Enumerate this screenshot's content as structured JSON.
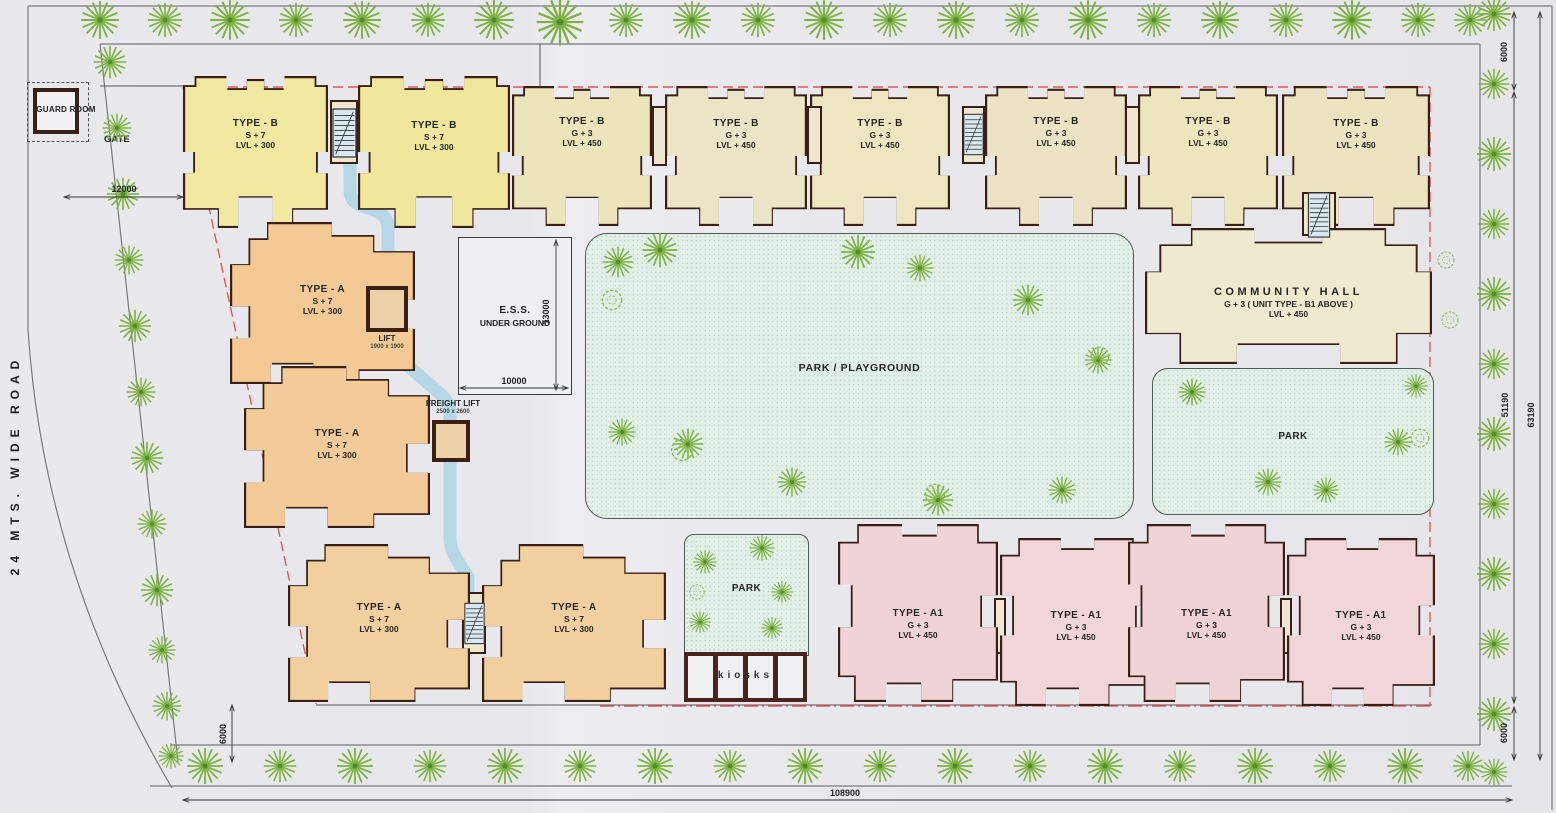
{
  "plan": {
    "road_label": "24 MTS. WIDE ROAD",
    "gate_label": "GATE",
    "guard_room_label": "GUARD ROOM"
  },
  "type_b_blocks": [
    {
      "name": "TYPE - B",
      "floors": "S + 7",
      "level": "LVL + 300"
    },
    {
      "name": "TYPE - B",
      "floors": "S + 7",
      "level": "LVL + 300"
    },
    {
      "name": "TYPE - B",
      "floors": "G + 3",
      "level": "LVL + 450"
    },
    {
      "name": "TYPE - B",
      "floors": "G + 3",
      "level": "LVL + 450"
    },
    {
      "name": "TYPE - B",
      "floors": "G + 3",
      "level": "LVL + 450"
    },
    {
      "name": "TYPE - B",
      "floors": "G + 3",
      "level": "LVL + 450"
    },
    {
      "name": "TYPE - B",
      "floors": "G + 3",
      "level": "LVL + 450"
    },
    {
      "name": "TYPE - B",
      "floors": "G + 3",
      "level": "LVL + 450"
    }
  ],
  "type_a_blocks": [
    {
      "name": "TYPE - A",
      "floors": "S + 7",
      "level": "LVL + 300"
    },
    {
      "name": "TYPE - A",
      "floors": "S + 7",
      "level": "LVL + 300"
    },
    {
      "name": "TYPE - A",
      "floors": "S + 7",
      "level": "LVL + 300"
    },
    {
      "name": "TYPE - A",
      "floors": "S + 7",
      "level": "LVL + 300"
    }
  ],
  "type_a1_blocks": [
    {
      "name": "TYPE - A1",
      "floors": "G + 3",
      "level": "LVL + 450"
    },
    {
      "name": "TYPE - A1",
      "floors": "G + 3",
      "level": "LVL + 450"
    },
    {
      "name": "TYPE - A1",
      "floors": "G + 3",
      "level": "LVL + 450"
    },
    {
      "name": "TYPE - A1",
      "floors": "G + 3",
      "level": "LVL + 450"
    }
  ],
  "community_hall": {
    "name": "COMMUNITY HALL",
    "floors": "G + 3 ( UNIT TYPE - B1 ABOVE )",
    "level": "LVL + 450"
  },
  "ess": {
    "line1": "E.S.S.",
    "line2": "UNDER GROUND"
  },
  "parks": {
    "playground": "PARK / PLAYGROUND",
    "east": "PARK",
    "south": "PARK"
  },
  "kiosks_label": "kiosks",
  "lift": {
    "label": "LIFT",
    "size": "1900 x 1900"
  },
  "freight_lift": {
    "label": "FREIGHT LIFT",
    "size": "2500 x 2600"
  },
  "dimensions": {
    "top_left": "12000",
    "ess_height": "13000",
    "ess_width": "10000",
    "top_right": "6000",
    "right_inner": "51190",
    "right_outer": "63190",
    "bottom_right": "6000",
    "bottom_left": "6000",
    "bottom": "108900"
  },
  "colors": {
    "wall": "#3a1f16",
    "boundary_red": "#e05858",
    "walkway_blue": "#b3d7e6",
    "type_b_yellow": "#f1e9a2",
    "type_b_cream": "#ece4c6",
    "type_a_orange": "#f3c995",
    "type_a1_pink": "#efd3d6",
    "park_green": "#e2efe8",
    "tree_green": "#7cb342"
  }
}
